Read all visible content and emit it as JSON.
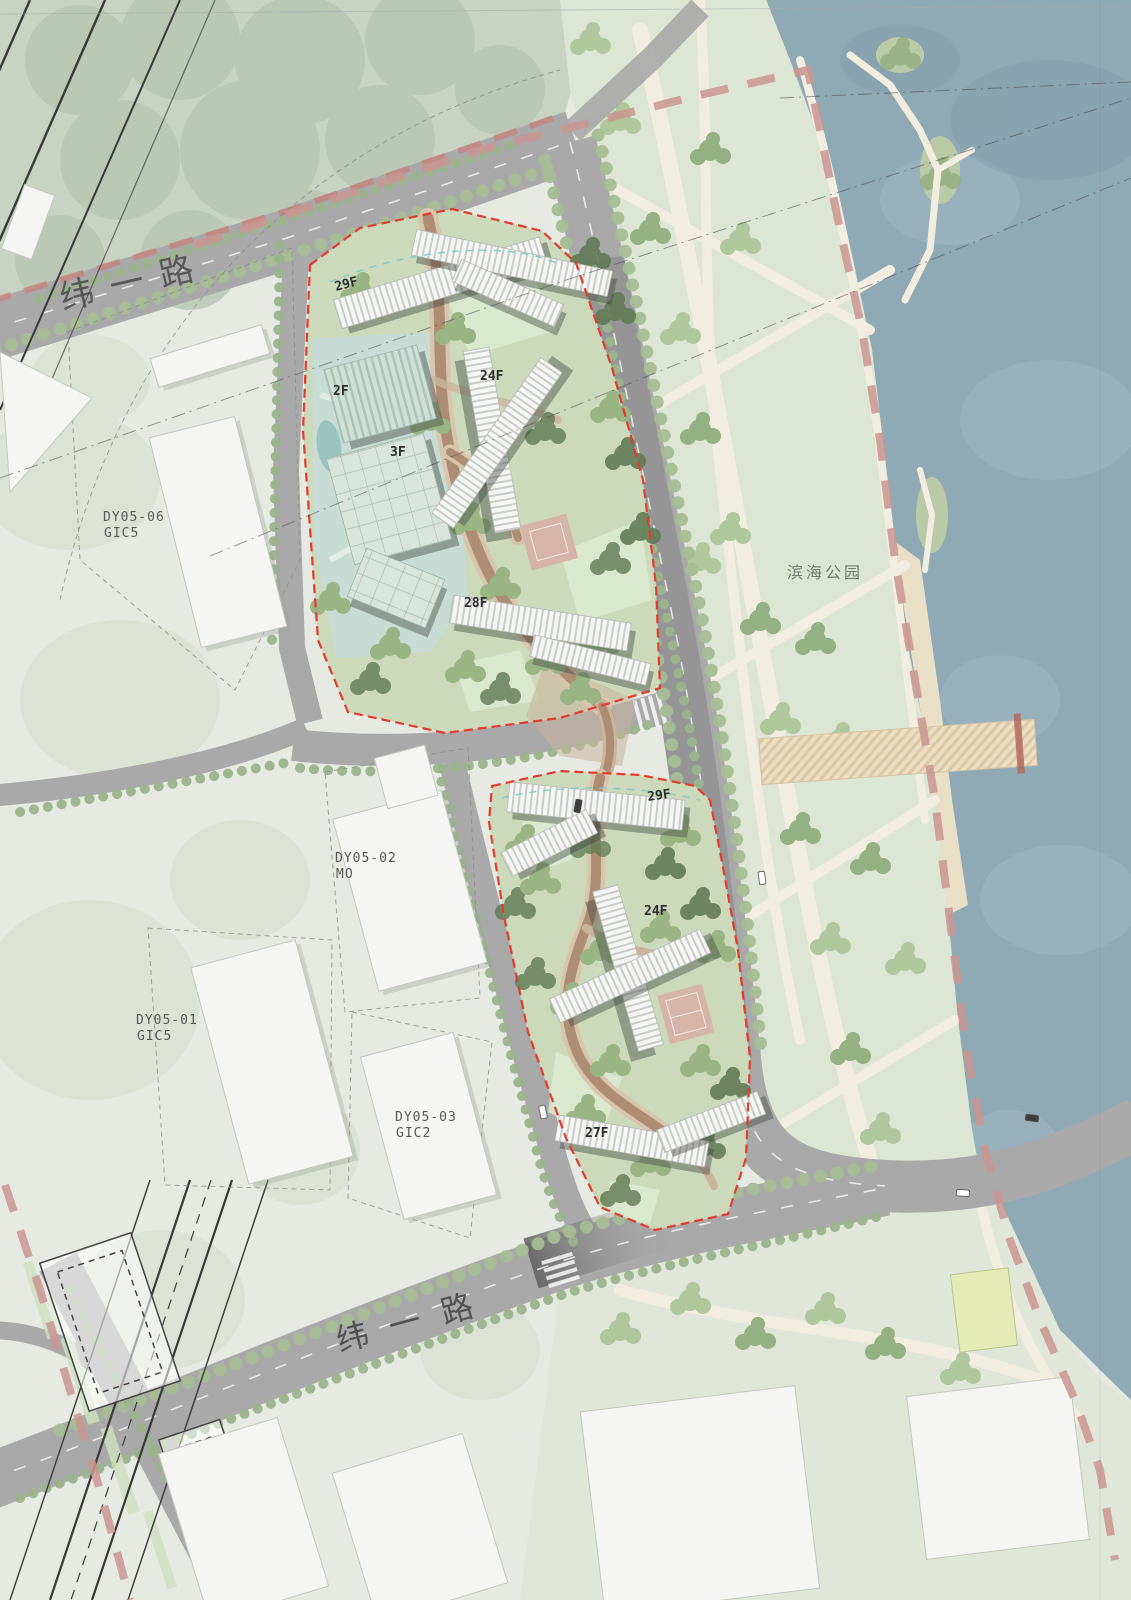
{
  "map": {
    "type": "site-plan",
    "road_labels": {
      "north_road": "纬一路",
      "south_road": "纬一路"
    },
    "area_labels": {
      "waterfront_park": "滨海公园"
    },
    "parcel_labels": [
      {
        "line1": "DY05-06",
        "line2": "GIC5"
      },
      {
        "line1": "DY05-02",
        "line2": "MO"
      },
      {
        "line1": "DY05-01",
        "line2": "GIC5"
      },
      {
        "line1": "DY05-03",
        "line2": "GIC2"
      }
    ],
    "floor_labels": [
      {
        "site": "north",
        "label": "29F"
      },
      {
        "site": "north",
        "label": "2F"
      },
      {
        "site": "north",
        "label": "3F"
      },
      {
        "site": "north",
        "label": "24F"
      },
      {
        "site": "north",
        "label": "28F"
      },
      {
        "site": "south",
        "label": "29F"
      },
      {
        "site": "south",
        "label": "24F"
      },
      {
        "site": "south",
        "label": "27F"
      }
    ],
    "colors": {
      "water": "#8fa9b5",
      "park_green": "#dce6d3",
      "tree_green": "#9cb78b",
      "road_gray": "#a9a9a9",
      "site_boundary_red": "#e23c2e",
      "planning_line_pink": "#c99590",
      "path_brown": "#ad8d74",
      "building_white": "#f6f7f4",
      "beach_sand": "#e9dfc6"
    }
  }
}
